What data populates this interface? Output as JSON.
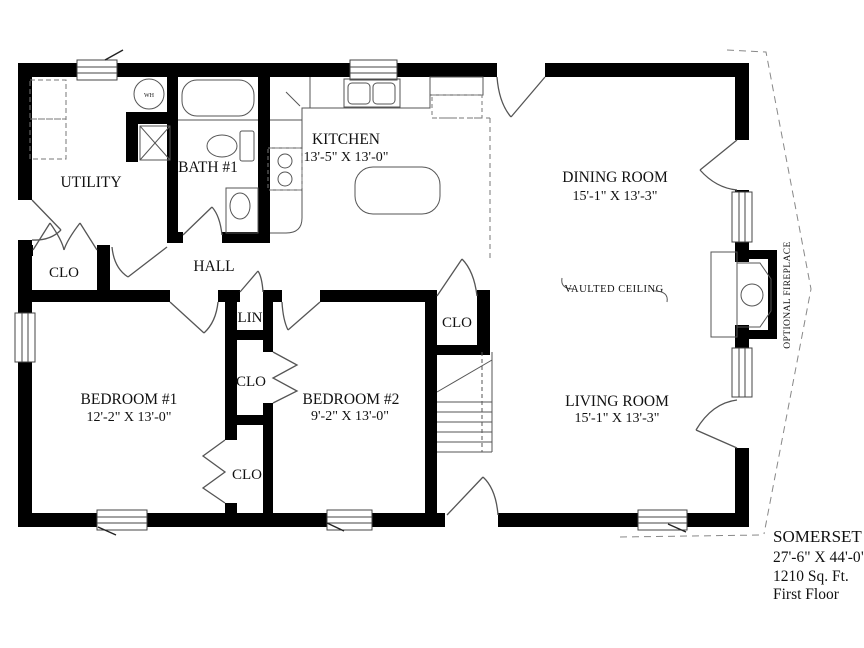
{
  "plan": {
    "title_block": {
      "model": "SOMERSET II",
      "dimensions": "27'-6\" X 44'-0\"",
      "area": "1210 Sq. Ft.",
      "floor": "First Floor"
    },
    "rooms": {
      "kitchen": {
        "name": "KITCHEN",
        "dims": "13'-5\" X 13'-0\""
      },
      "dining": {
        "name": "DINING ROOM",
        "dims": "15'-1\" X 13'-3\""
      },
      "living": {
        "name": "LIVING ROOM",
        "dims": "15'-1\" X 13'-3\""
      },
      "bedroom1": {
        "name": "BEDROOM #1",
        "dims": "12'-2\" X 13'-0\""
      },
      "bedroom2": {
        "name": "BEDROOM #2",
        "dims": "9'-2\" X 13'-0\""
      },
      "utility": {
        "name": "UTILITY"
      },
      "bath1": {
        "name": "BATH #1"
      },
      "hall": {
        "name": "HALL"
      }
    },
    "labels": {
      "closet": "CLO",
      "linen": "LIN",
      "vaulted_ceiling": "VAULTED CEILING",
      "optional_fireplace": "OPTIONAL FIREPLACE",
      "water_heater": "WH"
    },
    "colors": {
      "wall": "#000000",
      "line": "#555555",
      "background": "#ffffff"
    }
  }
}
